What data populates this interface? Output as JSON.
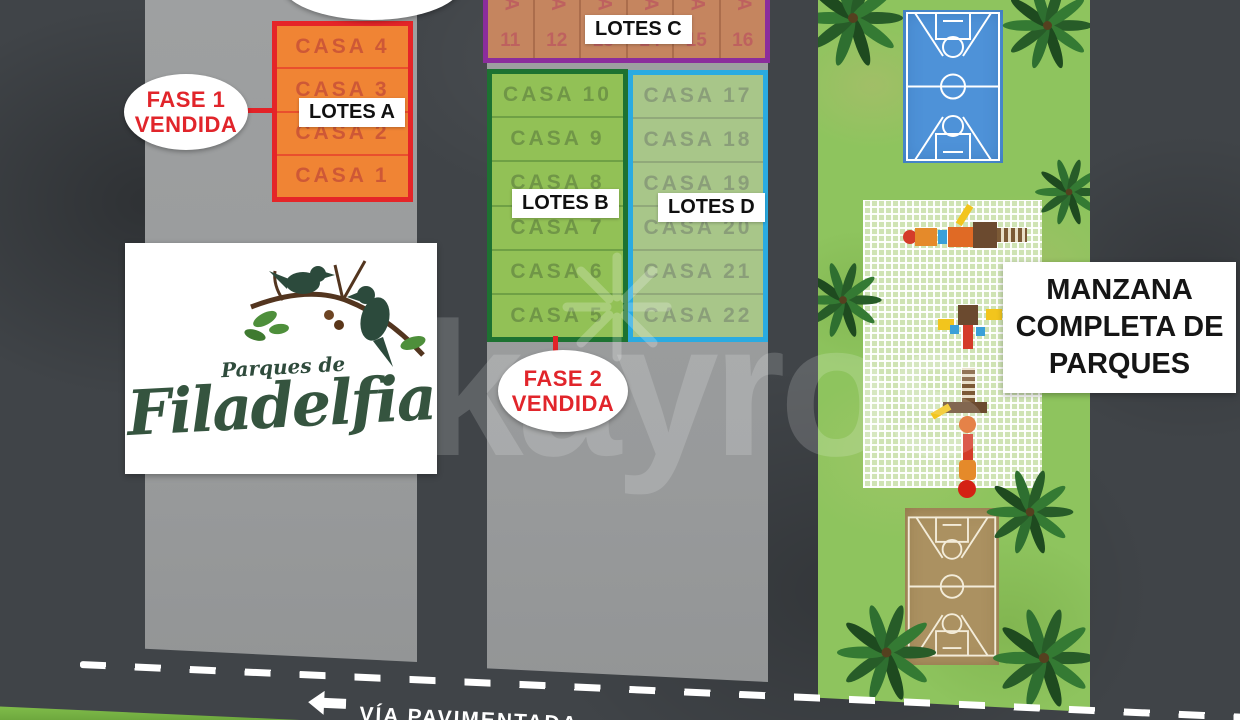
{
  "watermark": {
    "text": "kayros"
  },
  "fase1": {
    "line1": "FASE 1",
    "line2": "VENDIDA"
  },
  "fase2": {
    "line1": "FASE 2",
    "line2": "VENDIDA"
  },
  "blocks": {
    "lotes_a": {
      "label": "LOTES A",
      "units": [
        "CASA 4",
        "CASA 3",
        "CASA 2",
        "CASA 1"
      ],
      "fill": "#f08434",
      "border": "#e52528"
    },
    "lotes_b": {
      "label": "LOTES B",
      "units": [
        "CASA 10",
        "CASA 9",
        "CASA 8",
        "CASA 7",
        "CASA 6",
        "CASA 5"
      ],
      "fill": "#92c156",
      "border": "#1d7231"
    },
    "lotes_c": {
      "label": "LOTES C",
      "casa_word": "CASA",
      "numbers": [
        "11",
        "12",
        "13",
        "14",
        "15",
        "16"
      ],
      "fill": "#c5855f",
      "border": "#8b2d9c"
    },
    "lotes_d": {
      "label": "LOTES D",
      "units": [
        "CASA 17",
        "CASA 18",
        "CASA 19",
        "CASA 20",
        "CASA 21",
        "CASA 22"
      ],
      "fill": "#a8c689",
      "border": "#2aabe1"
    }
  },
  "logo": {
    "top": "Parques de",
    "main": "Filadelfia"
  },
  "park_label": {
    "line1": "MANZANA",
    "line2": "COMPLETA DE",
    "line3": "PARQUES"
  },
  "road": {
    "label": "VÍA PAVIMENTADA"
  },
  "colors": {
    "accent_red": "#e1252b",
    "orange": "#f08434",
    "green": "#92c156",
    "sage": "#a8c689",
    "tan": "#c5855f",
    "purple": "#8b2d9c",
    "cyan": "#2aabe1",
    "park_green": "#8ec45e",
    "court_blue": "#4e92d8",
    "court_brown": "#ab9161",
    "gray_lot": "#9c9ea0",
    "background": "#404448"
  }
}
